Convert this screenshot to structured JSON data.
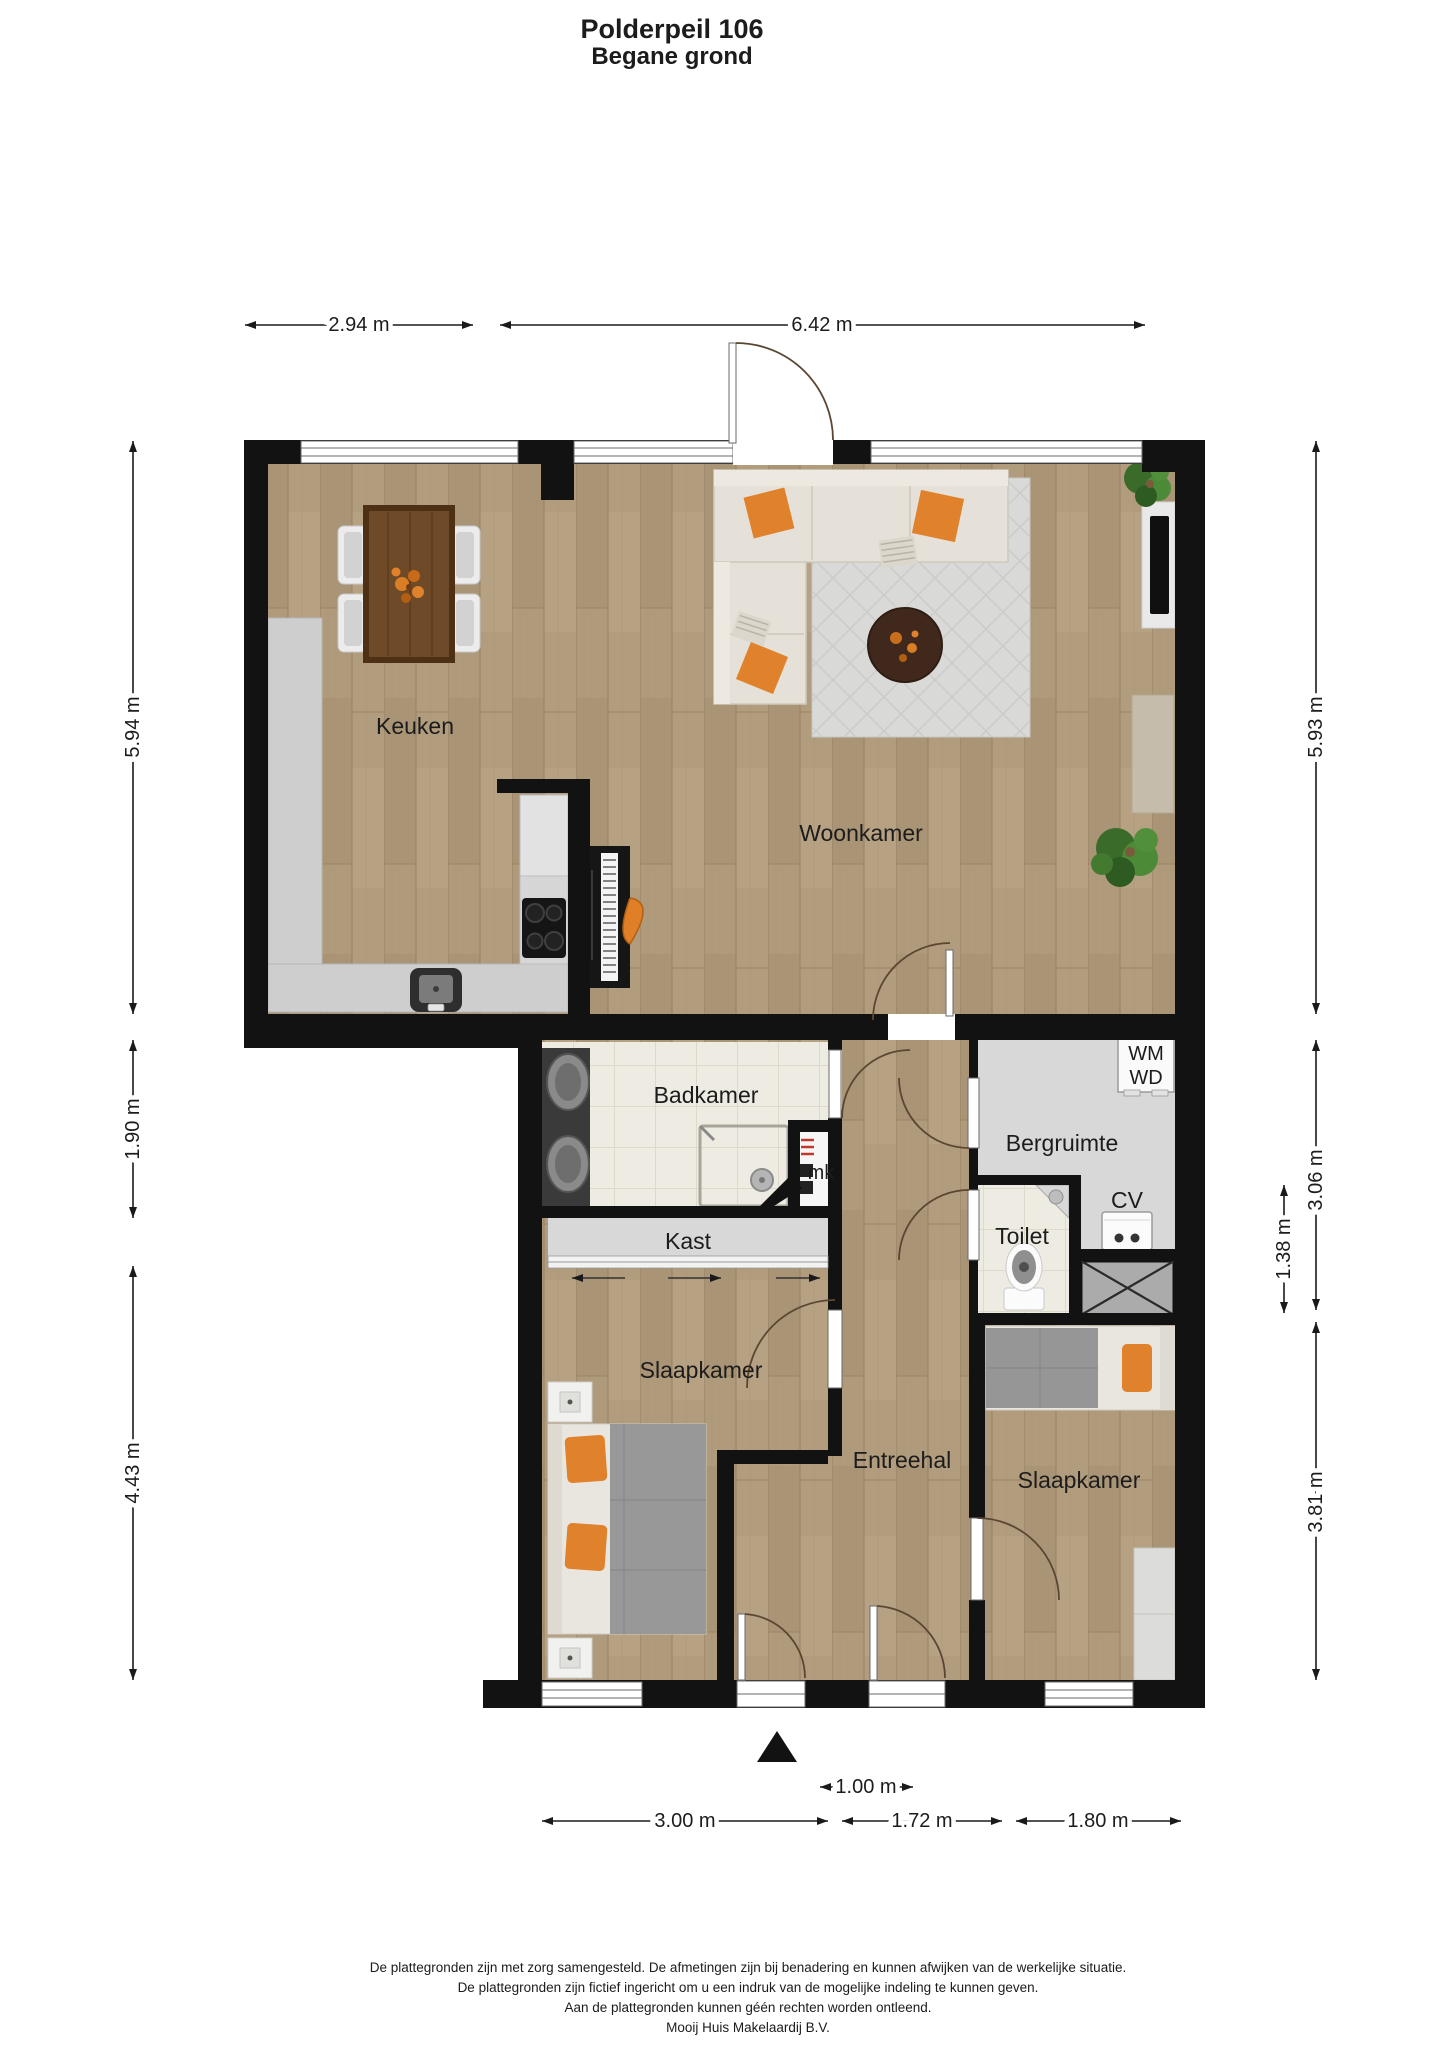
{
  "title": {
    "line1": "Polderpeil 106",
    "line2": "Begane grond"
  },
  "floor_plan": {
    "rooms": {
      "keuken": "Keuken",
      "woonkamer": "Woonkamer",
      "badkamer": "Badkamer",
      "kast": "Kast",
      "slaapkamer1": "Slaapkamer",
      "entreehal": "Entreehal",
      "bergruimte": "Bergruimte",
      "toilet": "Toilet",
      "slaapkamer2": "Slaapkamer"
    },
    "fixtures": {
      "mk": "mk",
      "cv": "CV",
      "wm": "WM",
      "wd": "WD"
    },
    "dimensions": {
      "top": [
        "2.94 m",
        "6.42 m"
      ],
      "left": [
        "5.94 m",
        "1.90 m",
        "4.43 m"
      ],
      "right": [
        "5.93 m",
        "3.06 m",
        "3.81 m"
      ],
      "right_inner": "1.38 m",
      "bottom": [
        "3.00 m",
        "1.72 m",
        "1.80 m"
      ],
      "bottom_inner": "1.00 m"
    }
  },
  "footer": {
    "lines": [
      "De plattegronden zijn met zorg samengesteld. De afmetingen zijn bij benadering en kunnen afwijken van de werkelijke situatie.",
      "De plattegronden zijn fictief ingericht om u een indruk van de mogelijke indeling te kunnen geven.",
      "Aan de plattegronden kunnen géén rechten worden ontleend.",
      "Mooij Huis Makelaardij B.V."
    ]
  },
  "colors": {
    "wall": "#121212",
    "wood_floor": "#b19c7d",
    "tile_floor": "#edebe2",
    "gray_floor": "#d8d8d8",
    "rug": "#d9d9d7",
    "sofa": "#e6e1d8",
    "accent_orange": "#e0812b",
    "table_wood": "#6f4a28"
  }
}
